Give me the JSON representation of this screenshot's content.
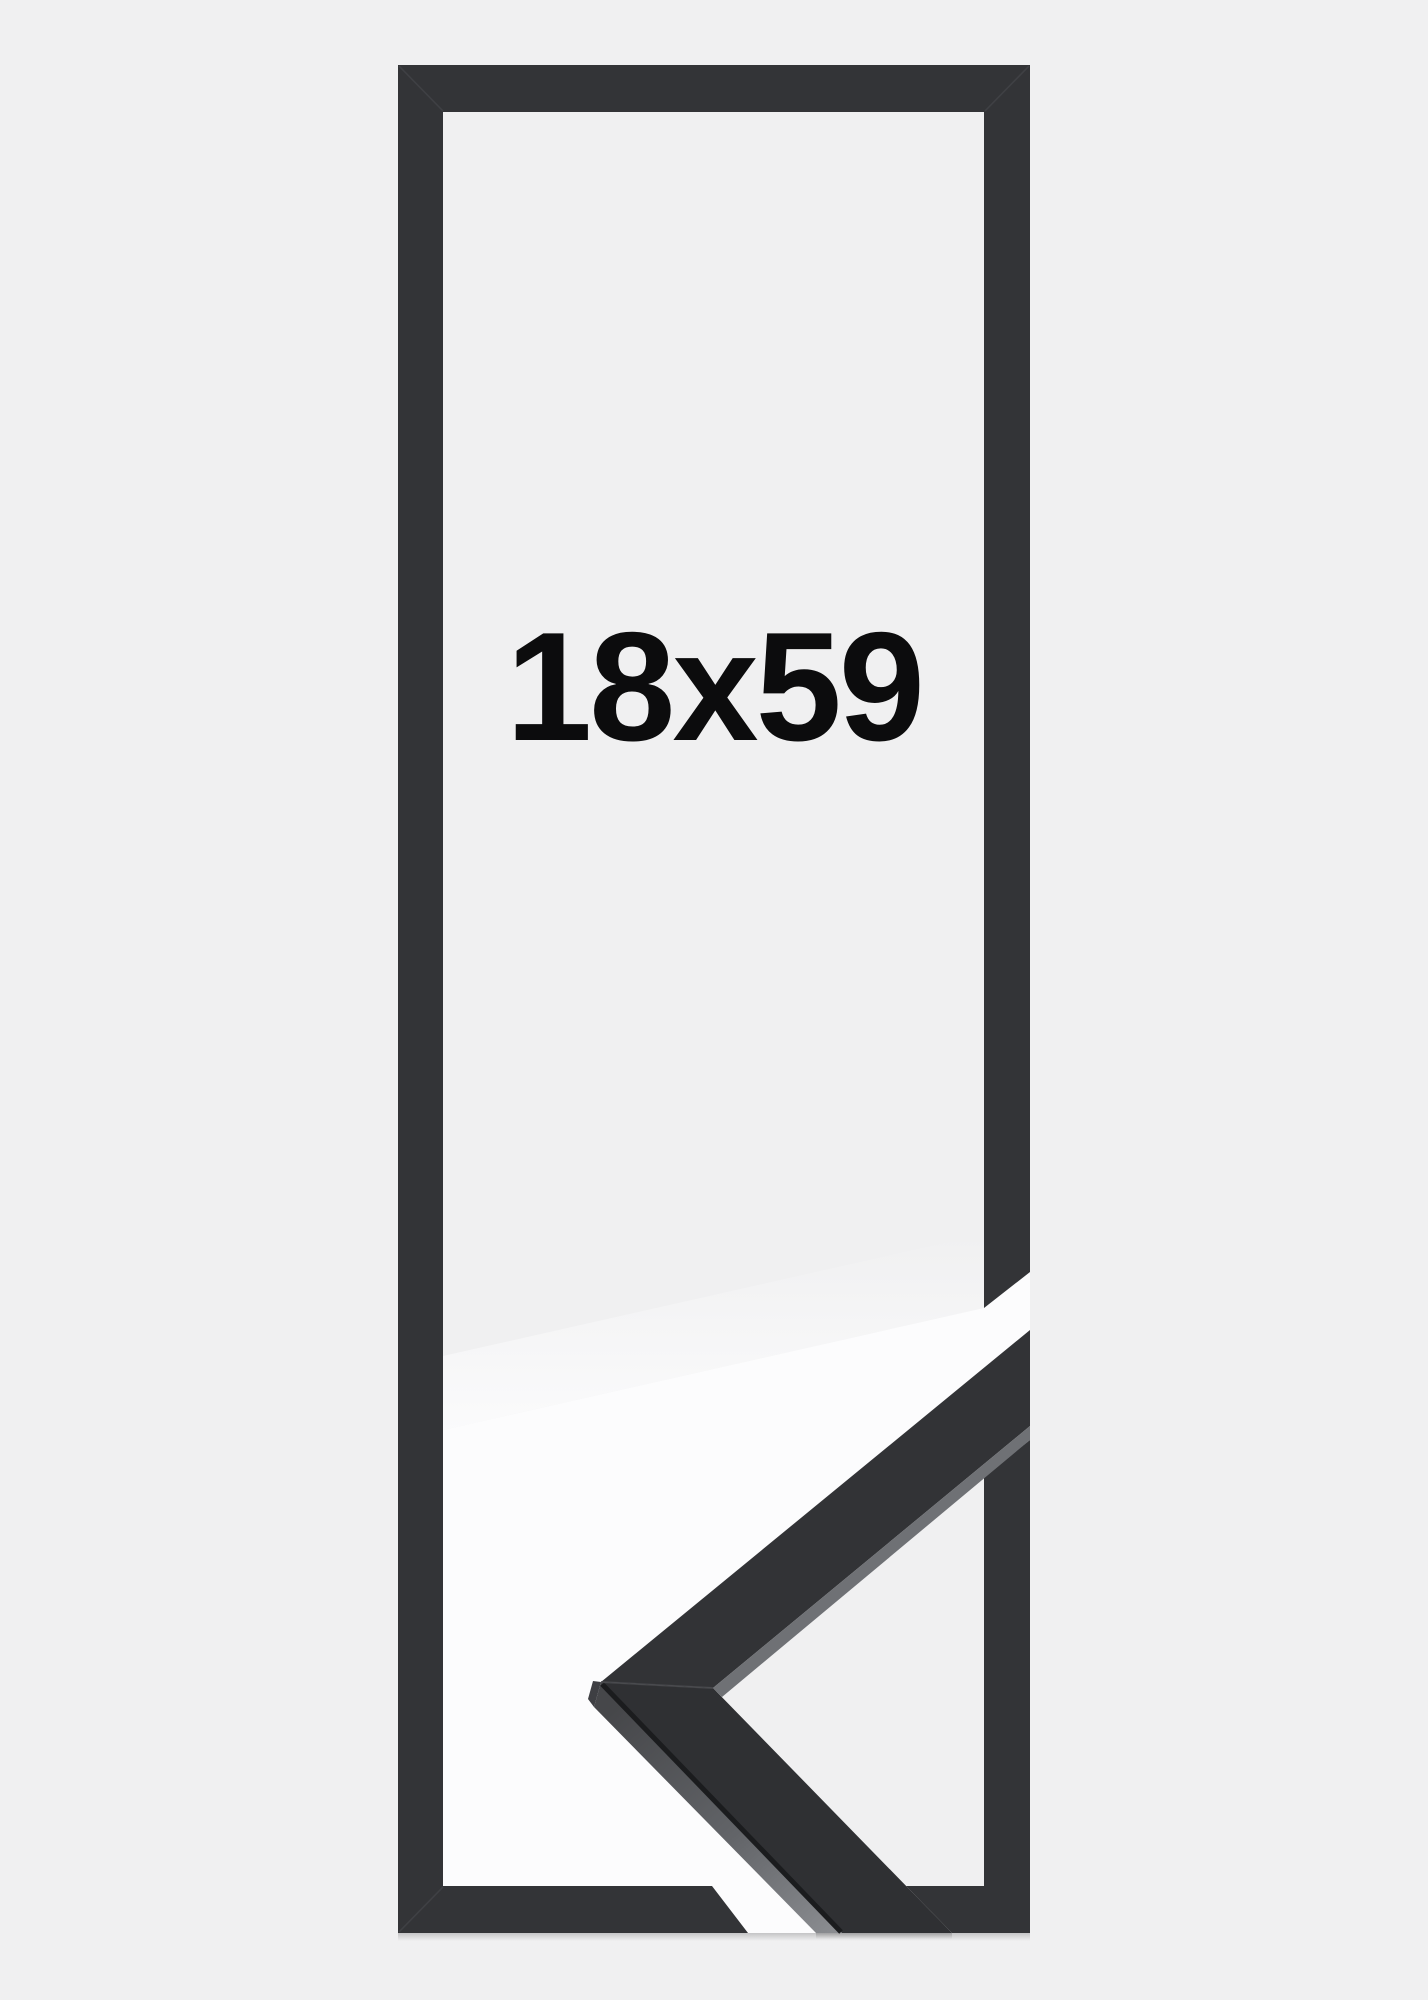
{
  "image": {
    "size_label": "18x59",
    "description_label": "black picture frame product image with corner profile sample",
    "colors": {
      "background": "#f0f0f1",
      "frame": "#333437",
      "photo_background": "#fcfcfd",
      "sample_top_face_upper": "#323336",
      "sample_top_face_lower": "#2f3033",
      "sample_lip_highlight": "#6f7175",
      "sample_edge_line": "#1b1c1e",
      "text": "#0c0c0d"
    }
  }
}
